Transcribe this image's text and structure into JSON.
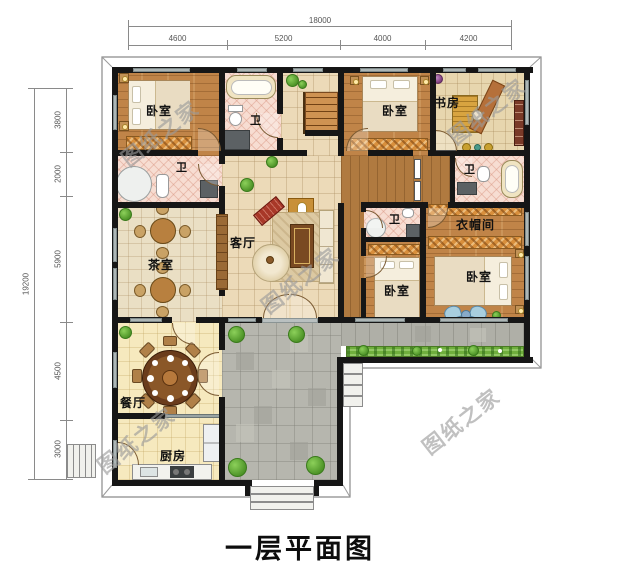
{
  "title": "一层平面图",
  "watermark": "图纸之家",
  "dimensions": {
    "top": {
      "total": "18000",
      "segments": [
        "4600",
        "5200",
        "4000",
        "4200"
      ]
    },
    "left": {
      "total": "19200",
      "segments": [
        "3800",
        "2000",
        "5900",
        "4500",
        "3000"
      ]
    }
  },
  "rooms": {
    "bedroom_tl": "卧室",
    "bath_top": "卫",
    "bedroom_t2": "卧室",
    "study": "书房",
    "bath_left": "卫",
    "tea": "茶室",
    "living": "客厅",
    "bath_rt": "卫",
    "bath_mid": "卫",
    "cloak": "衣帽间",
    "bedroom_mid": "卧室",
    "bedroom_r": "卧室",
    "dining": "餐厅",
    "kitchen": "厨房"
  }
}
